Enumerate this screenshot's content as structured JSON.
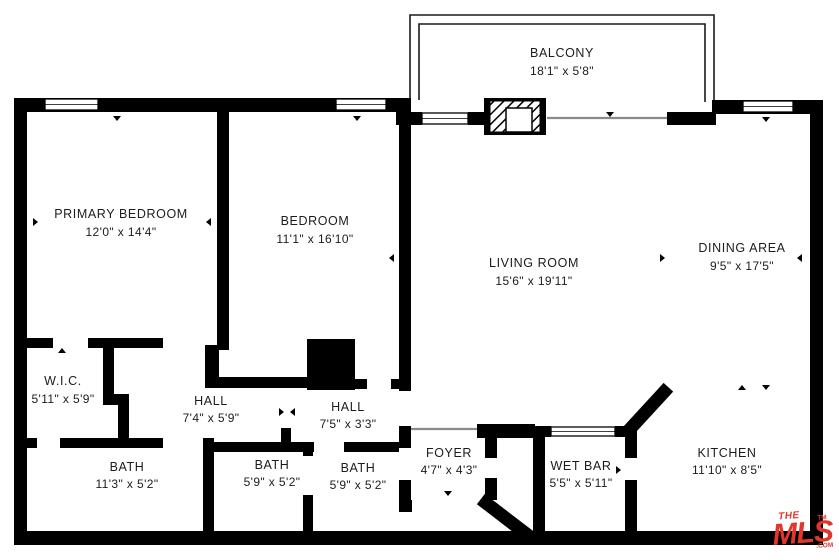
{
  "plan_title": "Condo Floor Plan",
  "rooms": [
    {
      "id": "balcony",
      "name": "BALCONY",
      "dims": "18'1\" x 5'8\""
    },
    {
      "id": "primary-bedroom",
      "name": "PRIMARY BEDROOM",
      "dims": "12'0\" x 14'4\""
    },
    {
      "id": "bedroom",
      "name": "BEDROOM",
      "dims": "11'1\" x 16'10\""
    },
    {
      "id": "living-room",
      "name": "LIVING ROOM",
      "dims": "15'6\" x 19'11\""
    },
    {
      "id": "dining-area",
      "name": "DINING AREA",
      "dims": "9'5\" x 17'5\""
    },
    {
      "id": "wic",
      "name": "W.I.C.",
      "dims": "5'11\" x 5'9\""
    },
    {
      "id": "hall-1",
      "name": "HALL",
      "dims": "7'4\" x 5'9\""
    },
    {
      "id": "hall-2",
      "name": "HALL",
      "dims": "7'5\" x 3'3\""
    },
    {
      "id": "foyer",
      "name": "FOYER",
      "dims": "4'7\" x 4'3\""
    },
    {
      "id": "wet-bar",
      "name": "WET BAR",
      "dims": "5'5\" x 5'11\""
    },
    {
      "id": "bath-1",
      "name": "BATH",
      "dims": "11'3\" x 5'2\""
    },
    {
      "id": "bath-2",
      "name": "BATH",
      "dims": "5'9\" x 5'2\""
    },
    {
      "id": "bath-3",
      "name": "BATH",
      "dims": "5'9\" x 5'2\""
    },
    {
      "id": "kitchen",
      "name": "KITCHEN",
      "dims": "11'10\" x 8'5\""
    }
  ],
  "logo": {
    "the": "THE",
    "mls": "MLS",
    "tld": ".COM",
    "tm": "TM",
    "color": "#e0362e"
  },
  "colors": {
    "wall": "#000000",
    "background": "#ffffff",
    "label": "#1c1c1c",
    "logo_red": "#e0362e"
  }
}
